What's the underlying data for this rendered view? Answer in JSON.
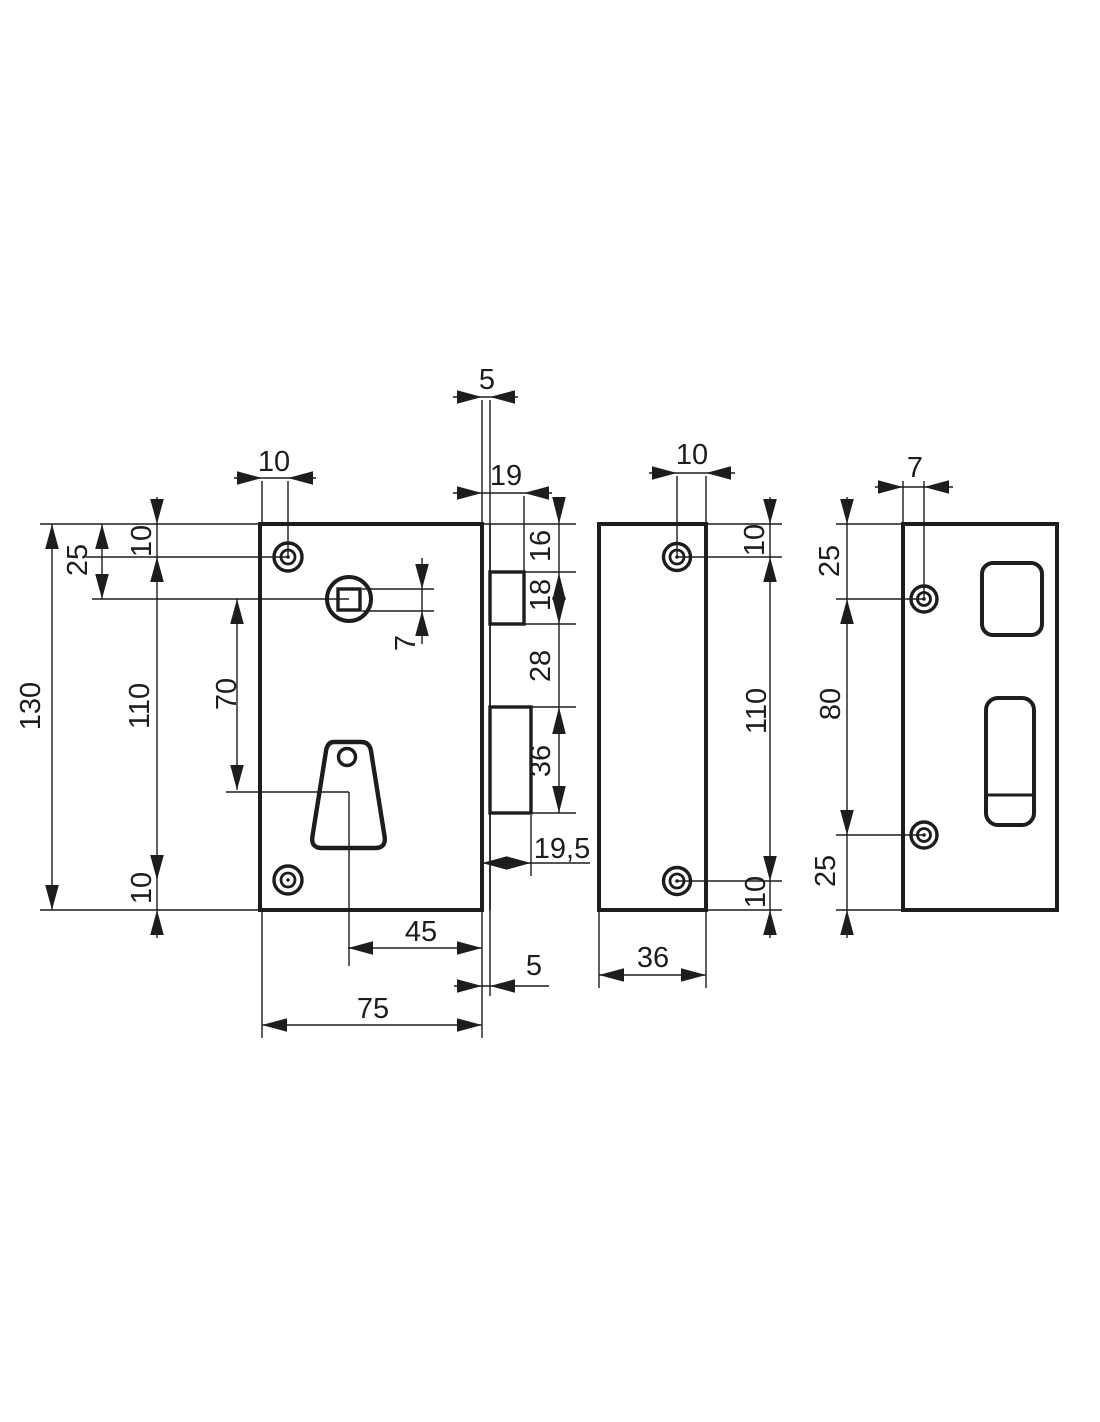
{
  "palette": {
    "ink": "#1d1d1b",
    "paper": "#ffffff"
  },
  "dims": {
    "front": {
      "screw_inset_top": "10",
      "faceplate_offset_top": "5",
      "latch_projection": "19",
      "top_to_latch": "16",
      "latch_height": "18",
      "latch_to_bolt": "28",
      "bolt_height": "36",
      "spindle_square": "7",
      "bolt_projection": "19,5",
      "keyhole_to_face": "45",
      "faceplate_offset_bottom": "5",
      "body_width": "75",
      "body_height": "130",
      "top_to_spindle": "25",
      "top_to_screw": "10",
      "screw_spacing": "110",
      "bottom_to_screw": "10",
      "spindle_to_keyhole": "70"
    },
    "edge": {
      "screw_inset": "10",
      "top_to_screw": "10",
      "screw_spacing": "110",
      "bottom_to_screw": "10",
      "depth": "36"
    },
    "back": {
      "screw_inset": "7",
      "top_to_screw": "25",
      "screw_spacing": "80",
      "bottom_to_screw": "25"
    }
  }
}
